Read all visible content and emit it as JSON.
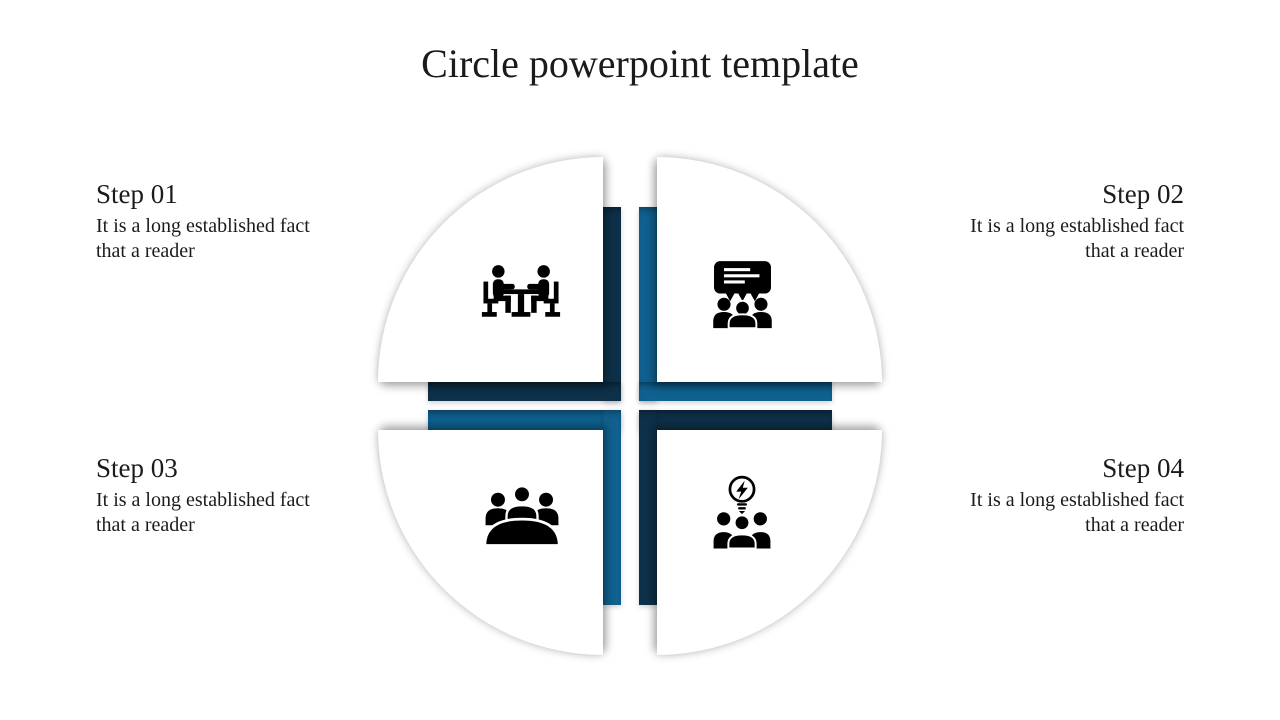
{
  "title": "Circle powerpoint template",
  "steps": [
    {
      "label": "Step 01",
      "body": "It is a long established fact that a reader",
      "icon": "meeting-table-icon",
      "position": "top-left"
    },
    {
      "label": "Step 02",
      "body": "It is a long established fact that a reader",
      "icon": "audience-message-icon",
      "position": "top-right"
    },
    {
      "label": "Step 03",
      "body": "It is a long established fact that a reader",
      "icon": "round-table-meeting-icon",
      "position": "bottom-left"
    },
    {
      "label": "Step 04",
      "body": "It is a long established fact that a reader",
      "icon": "team-idea-bulb-icon",
      "position": "bottom-right"
    }
  ],
  "colors": {
    "dark_navy": "#0e3149",
    "medium_blue": "#10618f",
    "icon_black": "#000000",
    "text": "#1b1b1b",
    "background": "#ffffff"
  }
}
